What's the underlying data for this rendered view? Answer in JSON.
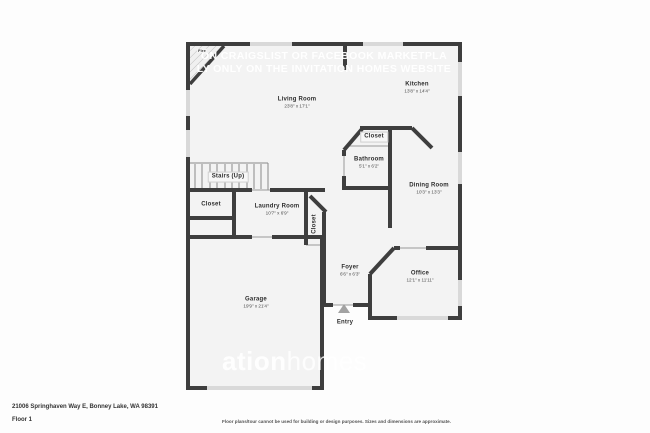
{
  "plan": {
    "watermark": {
      "line1": "ON CRAIGSLIST OR FACEBOOK MARKETPLA",
      "line2": "LY ONLY ON THE INVITATION HOMES WEBSITE",
      "brand_bold": "ation",
      "brand_light": "homes"
    },
    "rooms": {
      "fireplace": {
        "name": "Fire"
      },
      "living": {
        "name": "Living Room",
        "dims": "23'8\" x 17'1\""
      },
      "kitchen": {
        "name": "Kitchen",
        "dims": "13'8\" x 14'4\""
      },
      "closet_mid": {
        "name": "Closet"
      },
      "bathroom": {
        "name": "Bathroom",
        "dims": "5'1\" x 6'2\""
      },
      "dining": {
        "name": "Dining Room",
        "dims": "10'3\" x 13'3\""
      },
      "stairs": {
        "name": "Stairs (Up)"
      },
      "closet_left": {
        "name": "Closet"
      },
      "laundry": {
        "name": "Laundry Room",
        "dims": "10'7\" x 6'9\""
      },
      "closet_hall": {
        "name": "Closet"
      },
      "foyer": {
        "name": "Foyer",
        "dims": "6'6\" x 6'3\""
      },
      "office": {
        "name": "Office",
        "dims": "12'1\" x 11'11\""
      },
      "entry": {
        "name": "Entry"
      },
      "garage": {
        "name": "Garage",
        "dims": "19'9\" x 21'4\""
      }
    }
  },
  "footer": {
    "address": "21006 Springhaven Way E, Bonney Lake, WA 98391",
    "floor": "Floor 1",
    "disclaimer": "Floor plans/tour cannot be used for building or design purposes. Sizes and dimensions are approximate."
  }
}
